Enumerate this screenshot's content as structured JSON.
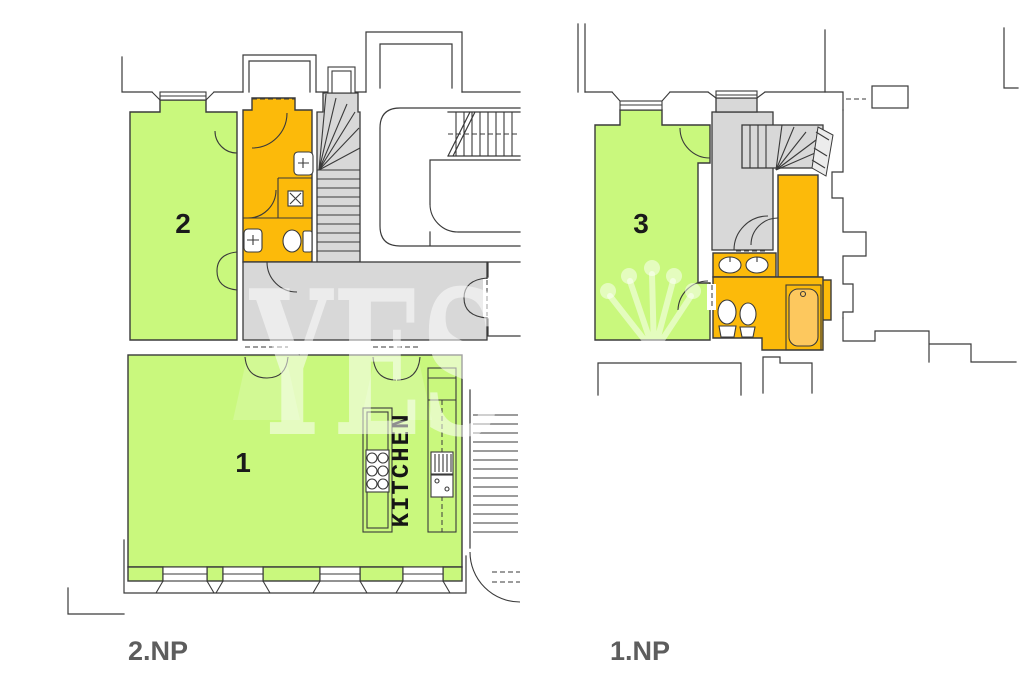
{
  "watermark": {
    "text": "YES"
  },
  "floors": {
    "second": {
      "label": "2.NP",
      "room1_number": "1",
      "room2_number": "2",
      "kitchen_label": "KITCHEN"
    },
    "first": {
      "label": "1.NP",
      "room3_number": "3"
    }
  },
  "colors": {
    "room_fill": "#c9f87d",
    "sanitary_fill": "#fcba0a",
    "circulation_fill": "#d8d8d8",
    "wall_line": "#3a3a3a",
    "room_label": "#1a1a1a",
    "floor_label": "#5d5d5d",
    "fixture_fill": "#ffffff",
    "tub_inner_fill": "#fdc85e"
  }
}
